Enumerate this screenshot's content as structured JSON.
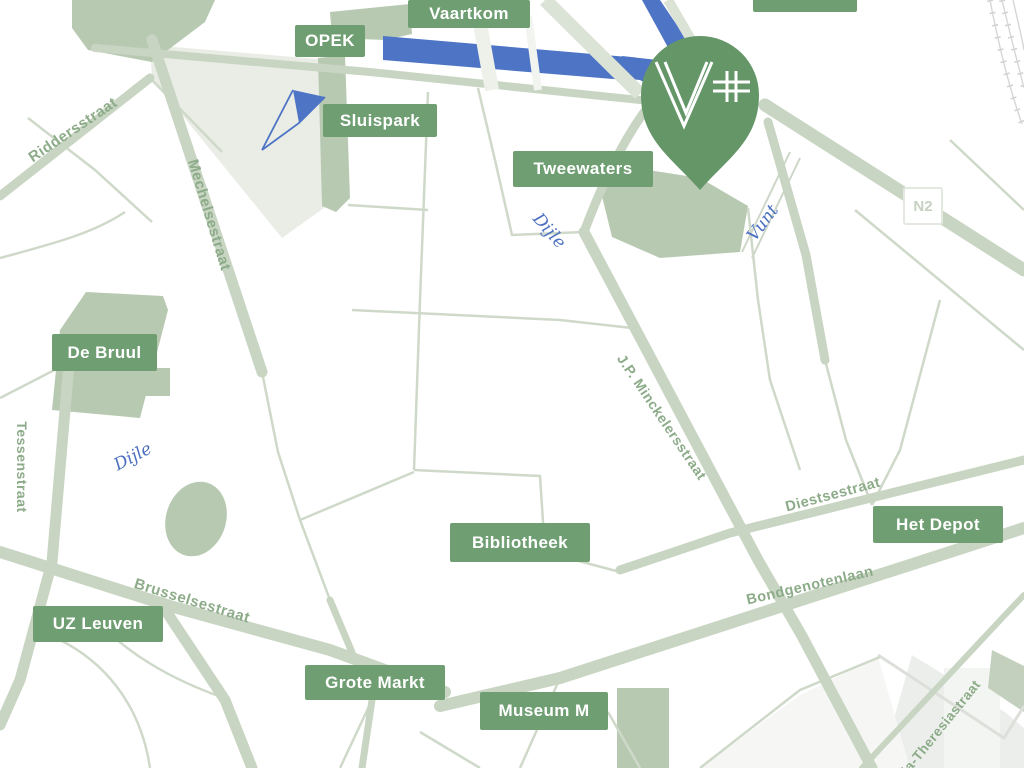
{
  "place_labels": [
    {
      "text": "Vaartkom"
    },
    {
      "text": "OPEK"
    },
    {
      "text": "Sluispark"
    },
    {
      "text": "Tweewaters"
    },
    {
      "text": "De Bruul"
    },
    {
      "text": "Bibliotheek"
    },
    {
      "text": "Het Depot"
    },
    {
      "text": "UZ Leuven"
    },
    {
      "text": "Grote Markt"
    },
    {
      "text": "Museum M"
    }
  ],
  "street_labels": [
    {
      "text": "Riddersstraat"
    },
    {
      "text": "Mechelsestraat"
    },
    {
      "text": "Tessenstraat"
    },
    {
      "text": "Brusselsestraat"
    },
    {
      "text": "J.P. Minckelersstraat"
    },
    {
      "text": "Diestsestraat"
    },
    {
      "text": "Bondgenotenlaan"
    },
    {
      "text": "Maria-Theresiastraat"
    }
  ],
  "water_labels": [
    {
      "text": "Dijle"
    },
    {
      "text": "Dijle"
    },
    {
      "text": "Vunt"
    }
  ],
  "road_badge": {
    "text": "N2"
  },
  "pin": {
    "logo": "V+"
  },
  "colors": {
    "label_green": "#6f9e72",
    "pin_green": "#649668",
    "road_sage": "#c9d5c3",
    "minor_road_sage": "#cfd9c9",
    "park_sage": "#b8c9b2",
    "water_blue": "#4d74c5",
    "street_text_green": "#8cab88",
    "water_text_blue": "#4a6fc0",
    "badge_text": "#c6d1c2"
  }
}
